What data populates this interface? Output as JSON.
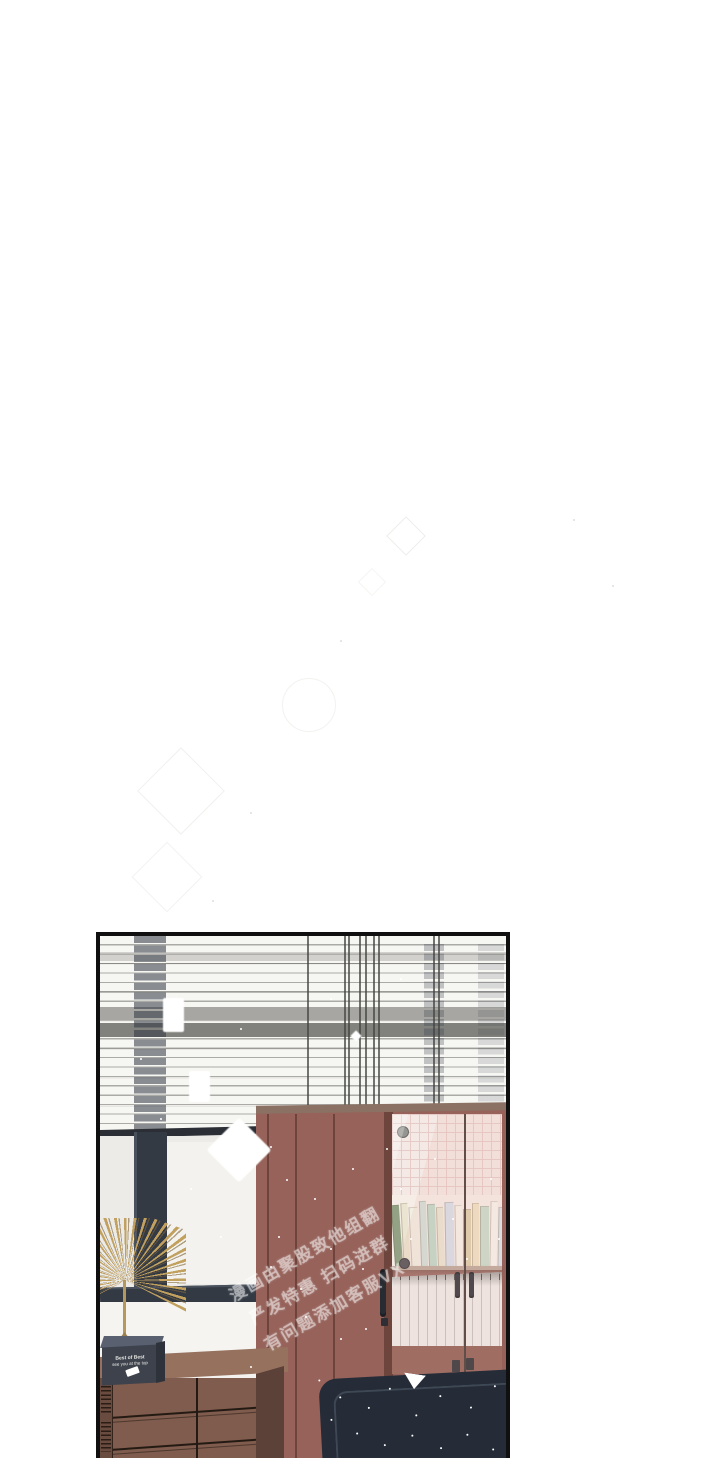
{
  "page": {
    "type": "webtoon-comic-page",
    "background": "#ffffff"
  },
  "watermark": {
    "rotation_deg": -30,
    "lines": [
      "漫画由聚股致他组翻",
      "严发特惠 扫码进群",
      "有问题添加客服VX"
    ]
  },
  "trophy_plaque": {
    "line1": "Best of Best",
    "line2": "see you at the top"
  },
  "bookshelf": {
    "spines": [
      {
        "w": 7,
        "h": 62,
        "c": "#8d9d7d",
        "r": -4
      },
      {
        "w": 6,
        "h": 64,
        "c": "#e9e3cd",
        "r": -3
      },
      {
        "w": 8,
        "h": 60,
        "c": "#f1eee2",
        "r": -3
      },
      {
        "w": 6,
        "h": 66,
        "c": "#cfdfd8",
        "r": -2
      },
      {
        "w": 7,
        "h": 63,
        "c": "#bcd7c7",
        "r": -2
      },
      {
        "w": 6,
        "h": 60,
        "c": "#e9e5cf",
        "r": -2
      },
      {
        "w": 8,
        "h": 65,
        "c": "#d5dee9",
        "r": -1
      },
      {
        "w": 6,
        "h": 62,
        "c": "#f5f3eb",
        "r": -1
      },
      {
        "w": 7,
        "h": 58,
        "c": "#dacca7",
        "r": 0
      },
      {
        "w": 6,
        "h": 64,
        "c": "#eee1c2",
        "r": 0
      },
      {
        "w": 8,
        "h": 61,
        "c": "#c6dbca",
        "r": 0
      },
      {
        "w": 6,
        "h": 66,
        "c": "#f7f5ee",
        "r": 1
      },
      {
        "w": 7,
        "h": 60,
        "c": "#d8e3e9",
        "r": 1
      },
      {
        "w": 6,
        "h": 63,
        "c": "#eadbb0",
        "r": 2
      },
      {
        "w": 7,
        "h": 59,
        "c": "#b4cabb",
        "r": 2
      },
      {
        "w": 6,
        "h": 62,
        "c": "#f0efe7",
        "r": 3
      },
      {
        "w": 7,
        "h": 57,
        "c": "#d4cbb0",
        "r": 3
      }
    ]
  },
  "colors": {
    "cabinet": "#96625a",
    "couch": "#252c38",
    "window_frame": "#333a44",
    "chest_front": "#7f5c4d",
    "gold": "#c2a05e",
    "glass_interior": "#f3e8e4",
    "panel_border": "#101010"
  }
}
